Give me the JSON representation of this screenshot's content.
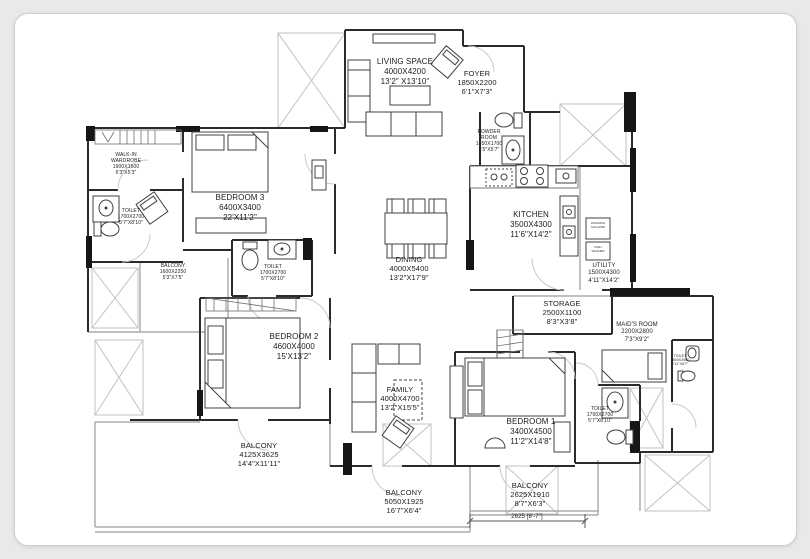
{
  "colors": {
    "background": "#e9e9e9",
    "card": "#ffffff",
    "wall": "#2b2b2b",
    "text": "#1c1c1c"
  },
  "rooms": [
    {
      "name": "LIVING SPACE",
      "mm": "4000X4200",
      "ft": "13'2\" X13'10\""
    },
    {
      "name": "FOYER",
      "mm": "1850X2200",
      "ft": "6'1\"X7'3\""
    },
    {
      "name": "POWDER",
      "name2": "ROOM",
      "mm": "1650X1700",
      "ft": "5'5\"X5'7\""
    },
    {
      "name": "WALK-IN",
      "name2": "WARDROBE",
      "mm": "1900X1600",
      "ft": "6'3\"X5'3\""
    },
    {
      "name": "TOILET",
      "mm": "1700X2700",
      "ft": "5'7\"X8'10\""
    },
    {
      "name": "BEDROOM 3",
      "mm": "6400X3400",
      "ft": "22'X11'2\""
    },
    {
      "name": "BALCONY",
      "mm": "1600X2250",
      "ft": "5'3\"X7'5\""
    },
    {
      "name": "TOILET",
      "mm": "1700X2700",
      "ft": "5'7\"X8'10\""
    },
    {
      "name": "DINING",
      "mm": "4000X5400",
      "ft": "13'2\"X17'9\""
    },
    {
      "name": "KITCHEN",
      "mm": "3500X4300",
      "ft": "11'6\"X14'2\""
    },
    {
      "name": "UTILITY",
      "mm": "1500X4300",
      "ft": "4'11\"X14'2\""
    },
    {
      "name": "STORAGE",
      "mm": "2500X1100",
      "ft": "8'3\"X3'8\""
    },
    {
      "name": "MAID'S ROOM",
      "mm": "2200X2800",
      "ft": "7'3\"X9'2\""
    },
    {
      "name": "TOILET",
      "mm": "1500X2000",
      "ft": "4'11\"X6'7\""
    },
    {
      "name": "BEDROOM 2",
      "mm": "4600X4000",
      "ft": "15'X13'2\""
    },
    {
      "name": "FAMILY",
      "mm": "4000X4700",
      "ft": "13'2\"X15'5\""
    },
    {
      "name": "BEDROOM 1",
      "mm": "3400X4500",
      "ft": "11'2\"X14'8\""
    },
    {
      "name": "TOILET",
      "mm": "1700X2700",
      "ft": "5'7\"X8'10\""
    },
    {
      "name": "BALCONY",
      "mm": "4125X3625",
      "ft": "14'4\"X11'11\""
    },
    {
      "name": "BALCONY",
      "mm": "5050X1925",
      "ft": "16'7\"X6'4\""
    },
    {
      "name": "BALCONY",
      "mm": "2625X1910",
      "ft": "8'7\"X6'3\""
    },
    {
      "name": "2625 [8'-7\"]"
    }
  ],
  "appliances": [
    {
      "line1": "WASHING",
      "line2": "MACHINE"
    },
    {
      "line1": "DISH",
      "line2": "WASHER"
    }
  ]
}
